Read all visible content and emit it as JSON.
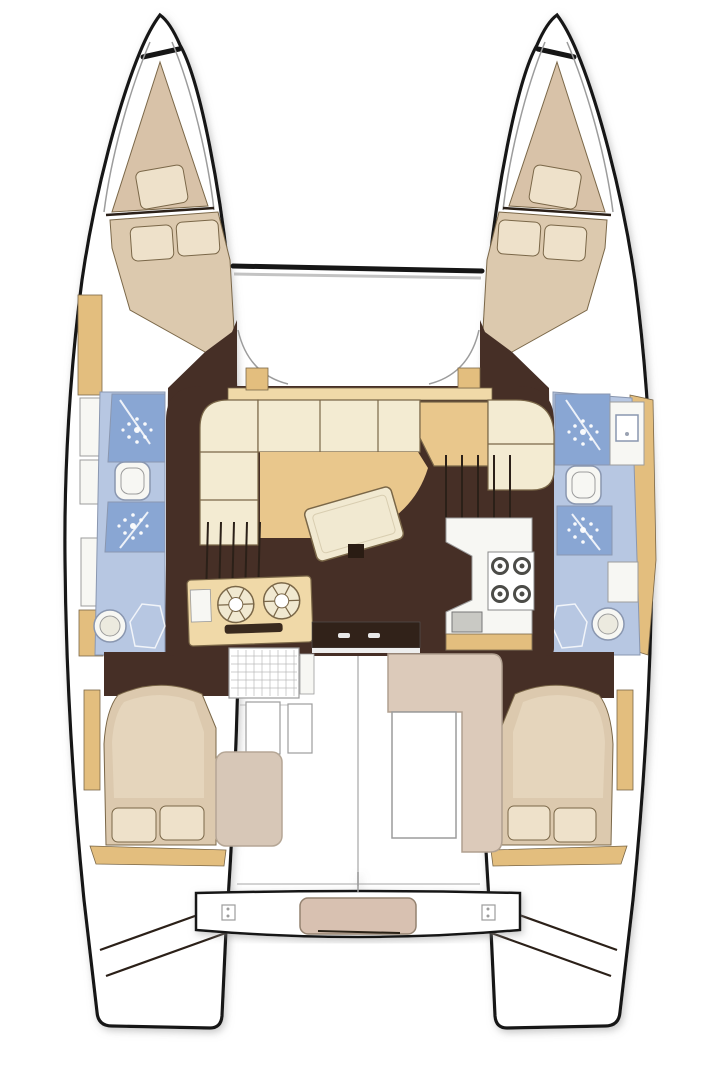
{
  "diagram": {
    "type": "boat-floor-plan",
    "subject": "catamaran-interior-layout-top-view",
    "rooms": [
      "trampoline-foredeck",
      "forepeak-berth-port",
      "forepeak-berth-starboard",
      "forward-cabin-port",
      "forward-cabin-starboard",
      "bathroom-shower-wc-port",
      "bathroom-shower-wc-starboard",
      "saloon-u-sofa-and-table",
      "navigation-table",
      "galley-port-twin-sinks",
      "galley-starboard-stove",
      "companionway-stairs-port",
      "companionway-stairs-starboard",
      "aft-cabin-port",
      "aft-cabin-starboard",
      "cockpit-l-sofa-and-table",
      "aft-bench-crossbeam",
      "transom-steps-port",
      "transom-steps-starboard"
    ]
  },
  "icons": {
    "shower-spray-icon": "radial-spray-of-dots",
    "toilet-icon": "rounded-white-square",
    "round-sink-icon": "double-circle-bowl",
    "square-sink-icon": "small-square-basin",
    "burner-icon": "circle-with-spokes",
    "stove-icon": "four-burner-rings",
    "cleat-icon": "small-square-with-dots",
    "door-handle-icon": "small-white-bar",
    "stairs-icon": "parallel-treads",
    "shower-hose-icon": "diagonal-line"
  },
  "colors": {
    "outline": "#161616",
    "deck-white": "#ffffff",
    "wood-tan": "#e3be7e",
    "wood-light": "#f0d9a8",
    "berth-beige": "#d8c2a8",
    "bed-beige": "#dcc9ae",
    "pillow-cream": "#eee1ca",
    "floor-brown": "#462f26",
    "door-dark": "#312219",
    "sofa-cream": "#f3ebd2",
    "golden-floor": "#e9c78c",
    "table-cream": "#f1e9d1",
    "bath-light": "#b7c7e2",
    "bath-mid": "#89a6d3",
    "bath-stroke": "#8a97b0",
    "fixture-white": "#f7f7f3",
    "cockpit-sofa": "#dccaba",
    "cockpit-seat": "#d7c7b7",
    "bench-blush": "#d8c1b1",
    "burner-dark": "#4c4c48",
    "line-dark": "#2b2018",
    "line-gray": "#9c9c9c",
    "trim-brown": "#7a6748"
  }
}
